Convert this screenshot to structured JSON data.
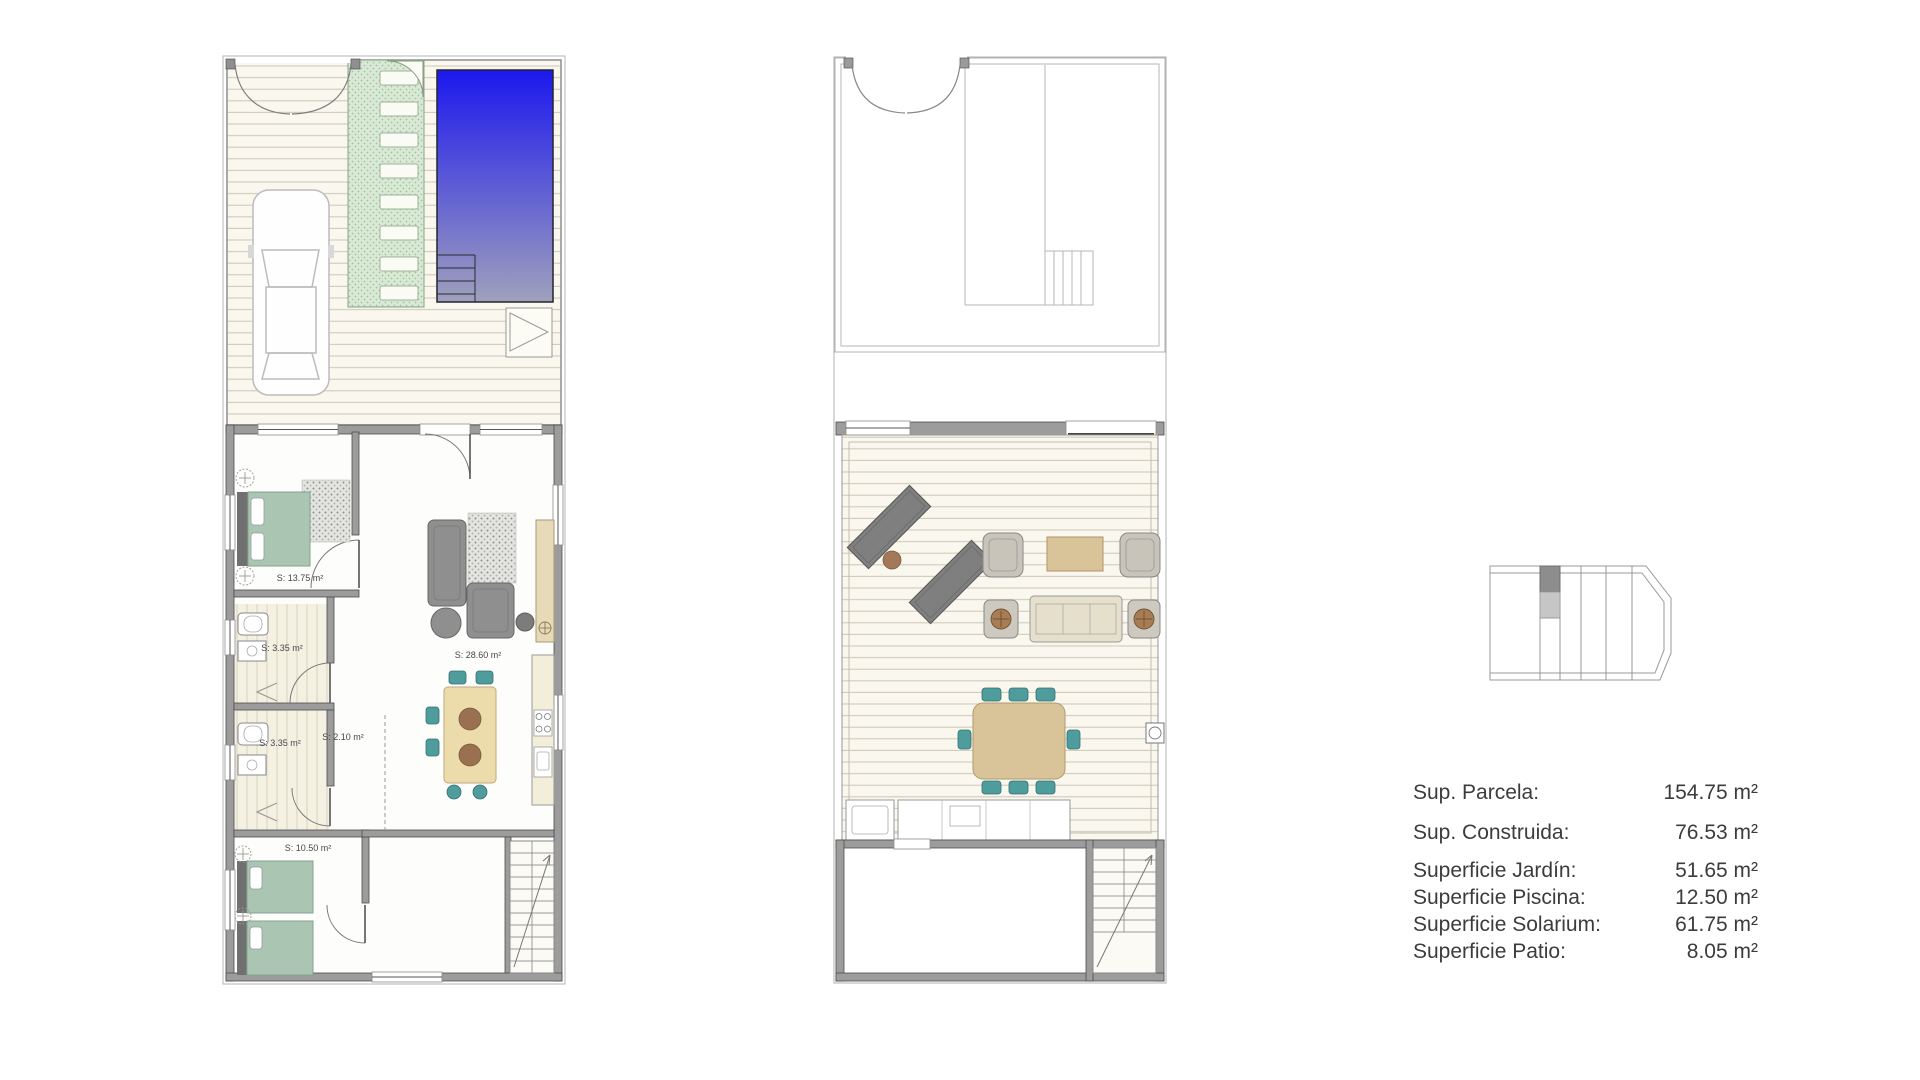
{
  "plans": {
    "ground_floor": {
      "room_labels": [
        {
          "room": "bedroom-1",
          "label": "S: 13.75 m²"
        },
        {
          "room": "bathroom-1",
          "label": "S: 3.35 m²"
        },
        {
          "room": "bathroom-2",
          "label": "S: 3.35 m²"
        },
        {
          "room": "hallway",
          "label": "S: 2.10 m²"
        },
        {
          "room": "living-kitchen",
          "label": "S: 28.60 m²"
        },
        {
          "room": "bedroom-2",
          "label": "S: 10.50 m²"
        }
      ]
    }
  },
  "areas_table": {
    "rows": [
      {
        "label": "Sup. Parcela:",
        "value": "154.75 m²"
      },
      {
        "label": "Sup. Construida:",
        "value": "76.53 m²"
      },
      {
        "label": "Superficie Jardín:",
        "value": "51.65 m²"
      },
      {
        "label": "Superficie Piscina:",
        "value": "12.50 m²"
      },
      {
        "label": "Superficie Solarium:",
        "value": "61.75 m²"
      },
      {
        "label": "Superficie Patio:",
        "value": "8.05 m²"
      }
    ]
  },
  "colors": {
    "pool_top": "#1c18ee",
    "pool_bottom": "#9fa0bc",
    "lawn": "#d9e9d5",
    "bed_green": "#aac5b2",
    "chair_teal": "#4e9c9c",
    "wood_tan": "#d9c49a",
    "sofa_gray": "#8f8f8f",
    "wall_gray": "#9c9c9c",
    "deck_cream": "#f9f7ee",
    "text": "#3c3c3c"
  }
}
